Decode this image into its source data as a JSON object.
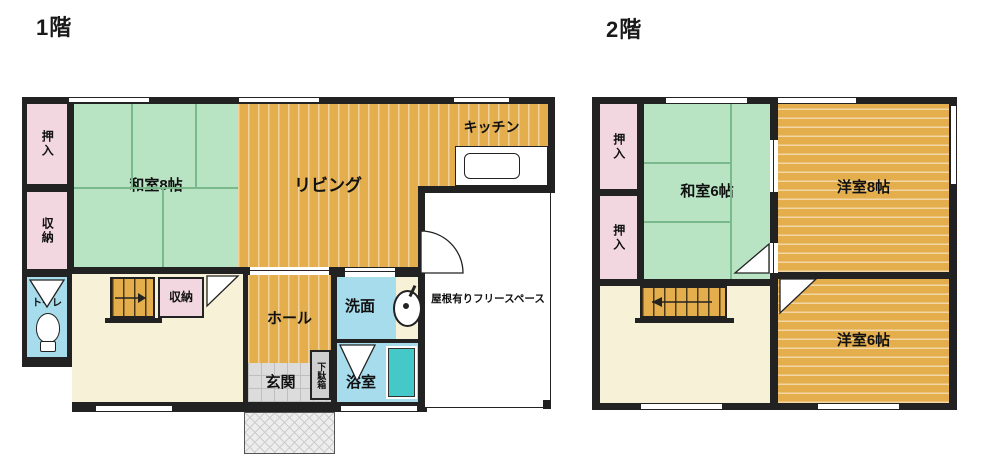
{
  "page_type": "japanese-house-floor-plan",
  "floors": {
    "floor1": {
      "title": "1階",
      "rooms": {
        "oshiire": {
          "label": "押入",
          "color": "#f2d7e0"
        },
        "shuno_left": {
          "label": "収納",
          "color": "#f2d7e0"
        },
        "toilet": {
          "label": "トイレ",
          "color": "#a6dcec"
        },
        "washitsu8": {
          "label": "和室8帖",
          "color": "#b9e4c4"
        },
        "living": {
          "label": "リビング",
          "color": "#e5ae4d"
        },
        "kitchen": {
          "label": "キッチン",
          "color": "#e5ae4d"
        },
        "shuno_stairs": {
          "label": "収納",
          "color": "#f2d7e0"
        },
        "hall": {
          "label": "ホール",
          "color": "#e5ae4d"
        },
        "genkan": {
          "label": "玄関",
          "color": "#dcdcdc"
        },
        "getabako": {
          "label": "下駄箱",
          "color": "#cfcfcf"
        },
        "senmen": {
          "label": "洗面",
          "color": "#a6dcec"
        },
        "yokushitsu": {
          "label": "浴室",
          "color": "#a6dcec"
        },
        "free_space": {
          "label": "屋根有りフリースペース",
          "color": "#ffffff"
        }
      }
    },
    "floor2": {
      "title": "2階",
      "rooms": {
        "oshiire_top": {
          "label": "押入",
          "color": "#f2d7e0"
        },
        "oshiire_bottom": {
          "label": "押入",
          "color": "#f2d7e0"
        },
        "washitsu6": {
          "label": "和室6帖",
          "color": "#b9e4c4"
        },
        "yoshitsu8": {
          "label": "洋室8帖",
          "color": "#e5ae4d"
        },
        "yoshitsu6": {
          "label": "洋室6帖",
          "color": "#e5ae4d"
        }
      }
    }
  },
  "colors": {
    "wall": "#222222",
    "tatami_green": "#b9e4c4",
    "wood_orange": "#e5ae4d",
    "closet_pink": "#f2d7e0",
    "water_blue": "#a6dcec",
    "bathtub_teal": "#45c8c8",
    "hall_cream": "#f6f1d7",
    "entry_gray": "#dcdcdc"
  }
}
